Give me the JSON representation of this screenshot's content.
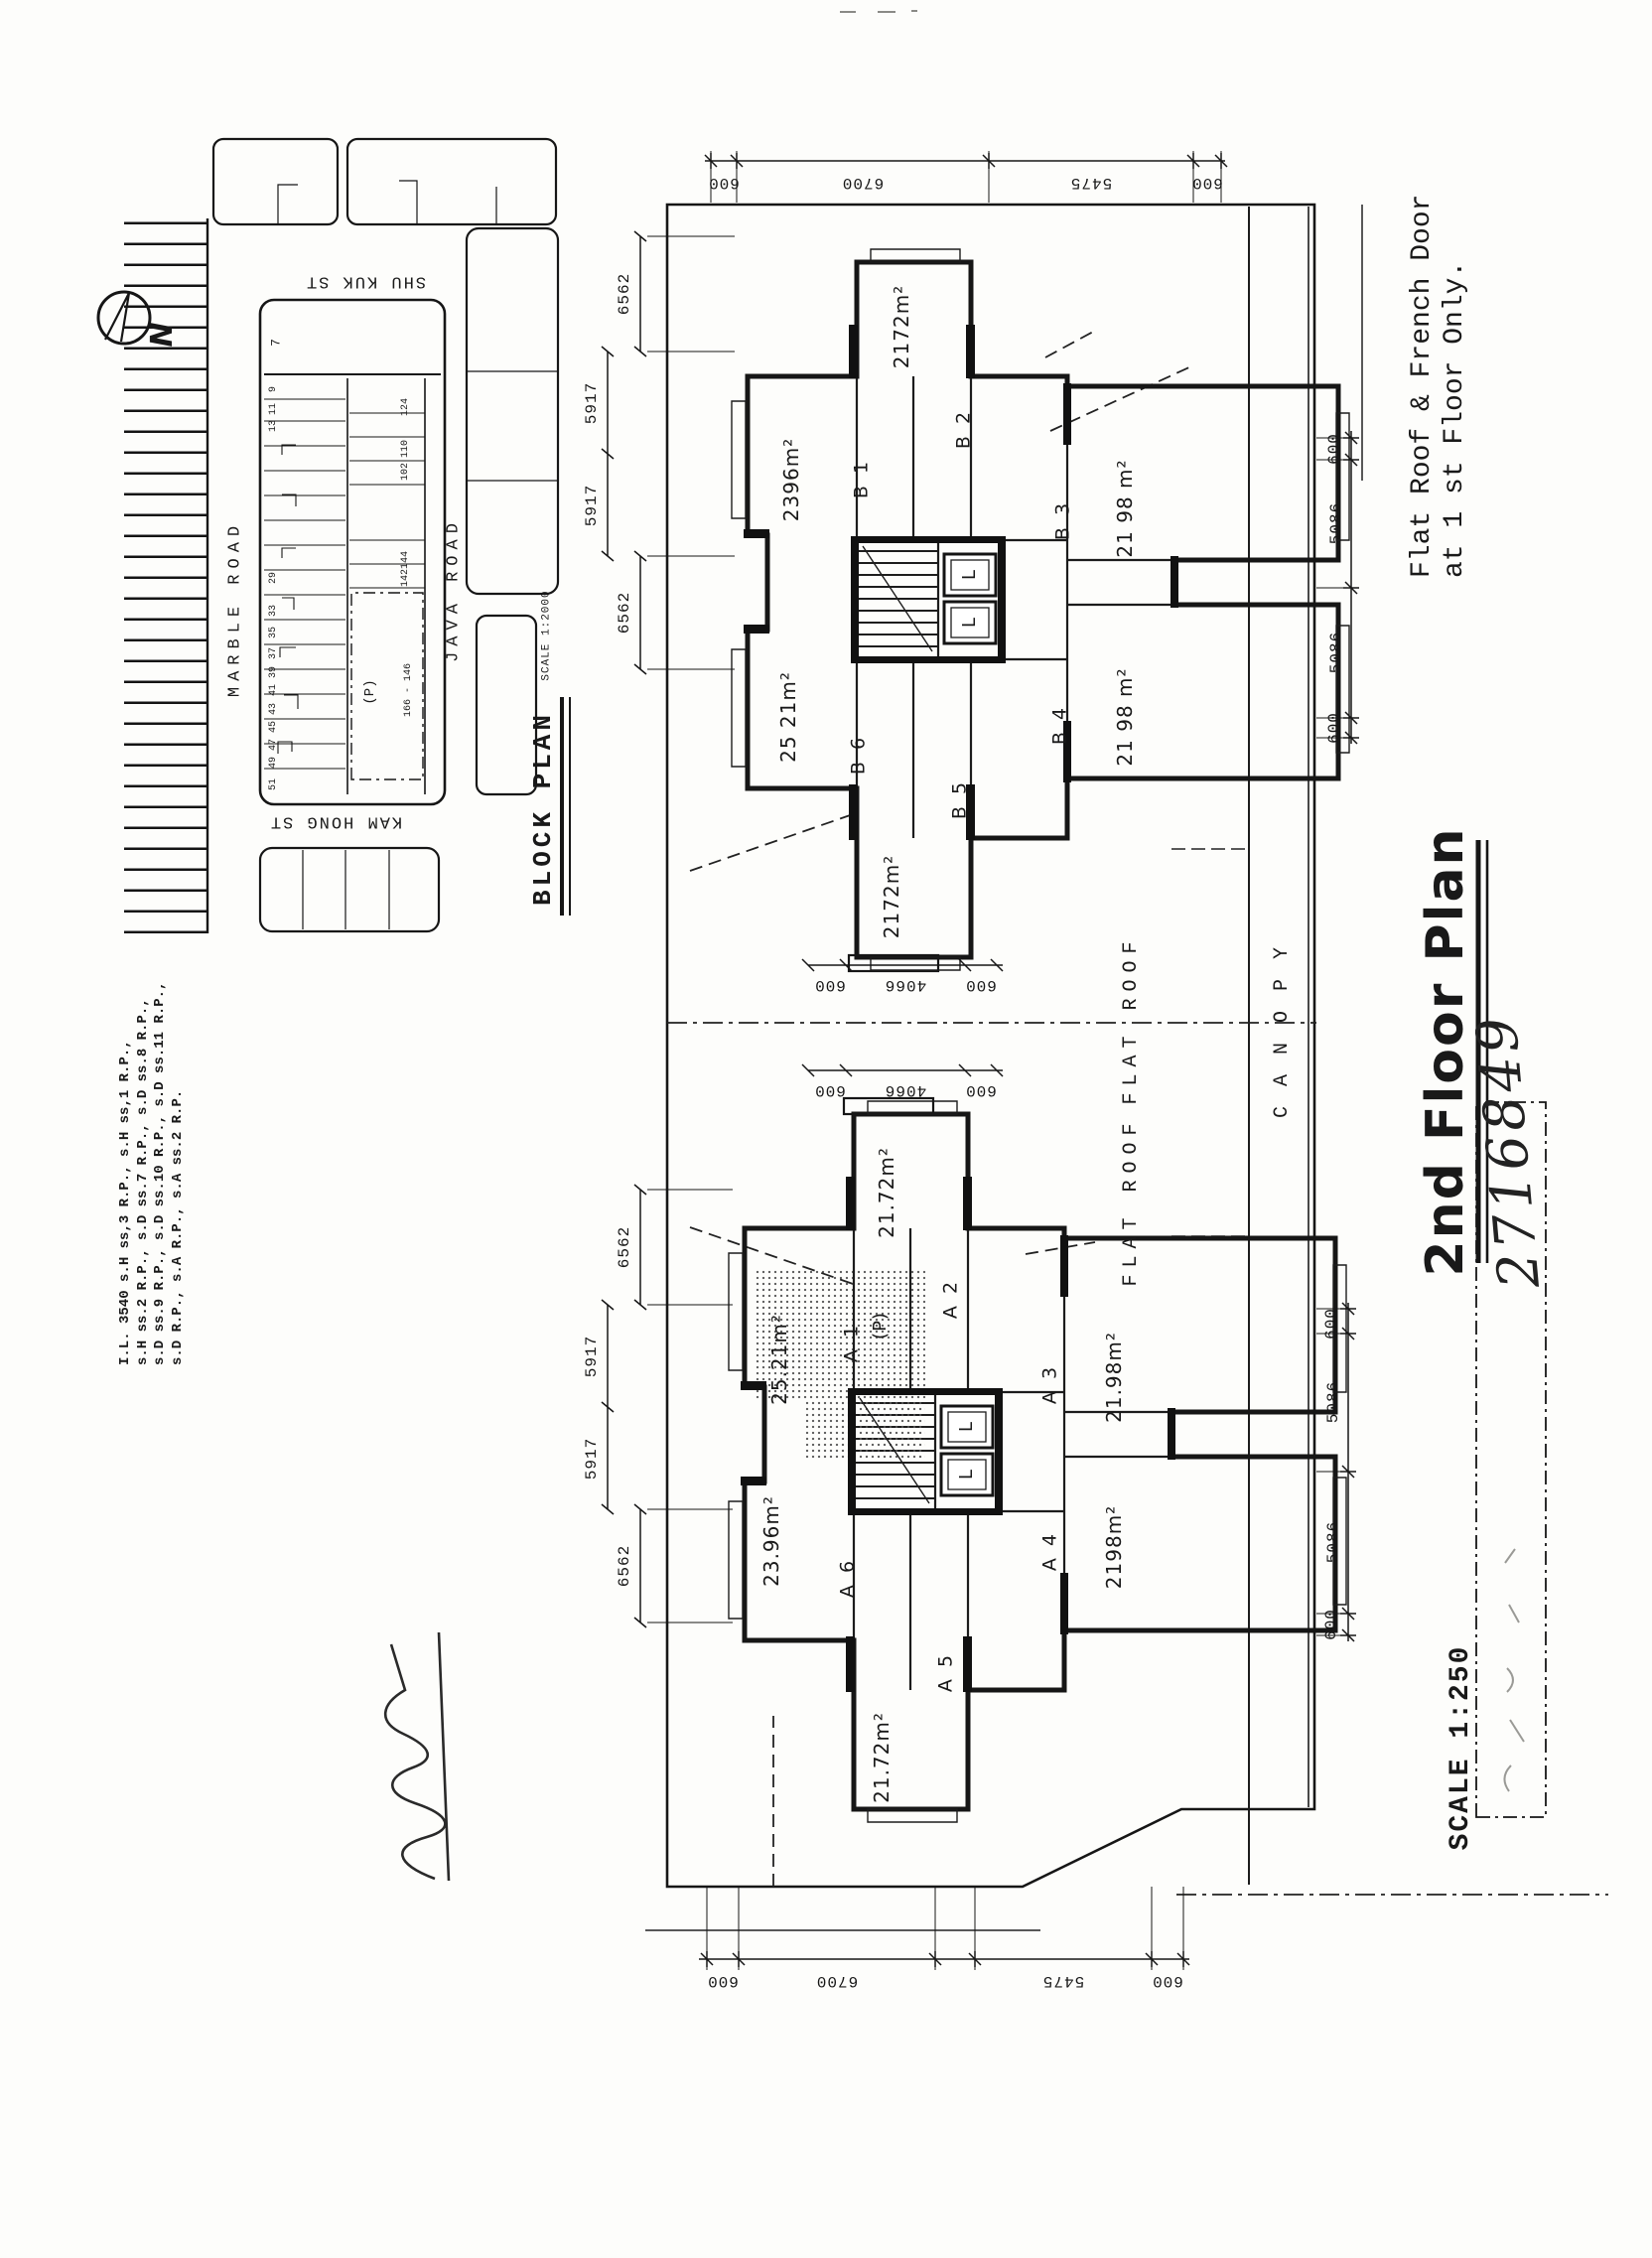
{
  "document": {
    "title": "2nd Floor Plan",
    "drawing_number": "2716849",
    "scale_label": "SCALE 1:250",
    "note": {
      "line1": "Flat Roof & French Door",
      "line2": "at 1 st Floor Only."
    },
    "lot_description": {
      "line1": "I.L. 3540 s.H ss,3 R.P., s.H ss,1 R.P.,",
      "line2": "s.H ss.2 R.P., s.D ss.7 R.P., s.D ss.8 R.P.,",
      "line3": "s.D ss.9 R.P., s.D ss.10 R.P., s.D ss.11 R.P.,",
      "line4": "s.D R.P., s.A R.P., s.A ss.2 R.P."
    }
  },
  "north_label": "N",
  "block_plan": {
    "title": "BLOCK PLAN",
    "scale": "SCALE 1:2000",
    "streets": {
      "shu_kuk": "SHU KUK ST",
      "marble": "MARBLE ROAD",
      "java": "JAVA ROAD",
      "kam_hong": "KAM HONG ST"
    },
    "lot_strip": "7",
    "parking_label": "(P)",
    "address_range": "166 - 146",
    "numbers_left": [
      "9",
      "11",
      "13",
      "29",
      "33",
      "35",
      "37",
      "39",
      "41",
      "43",
      "45",
      "47",
      "49",
      "51"
    ],
    "numbers_right": [
      "124",
      "110",
      "102",
      "144",
      "142"
    ]
  },
  "plan": {
    "flat_roof_label": "FLAT ROOF",
    "canopy_label": "CANOPY",
    "lift_label": "L",
    "parking_label": "(P)",
    "units_b": [
      {
        "id": "B 1",
        "area": "2396m²"
      },
      {
        "id": "B 2",
        "area": "2172m²"
      },
      {
        "id": "B 3",
        "area": "21 98 m²"
      },
      {
        "id": "B 4",
        "area": "21 98 m²"
      },
      {
        "id": "B 5",
        "area": "2172m²"
      },
      {
        "id": "B 6",
        "area": "25 21m²"
      }
    ],
    "units_a": [
      {
        "id": "A 1",
        "area": "25.21m²"
      },
      {
        "id": "A 2",
        "area": "21.72m²"
      },
      {
        "id": "A 3",
        "area": "21.98m²"
      },
      {
        "id": "A 4",
        "area": "2198m²"
      },
      {
        "id": "A 5",
        "area": "21.72m²"
      },
      {
        "id": "A 6",
        "area": "23.96m²"
      }
    ]
  },
  "dims": {
    "tower_top": [
      "6562",
      "5917",
      "5917",
      "6562"
    ],
    "site_side": [
      "600",
      "6700",
      "5475",
      "600"
    ],
    "tower_bottom": [
      "600",
      "5086",
      "5086",
      "600"
    ],
    "lobby": [
      "600",
      "4066",
      "600"
    ]
  }
}
